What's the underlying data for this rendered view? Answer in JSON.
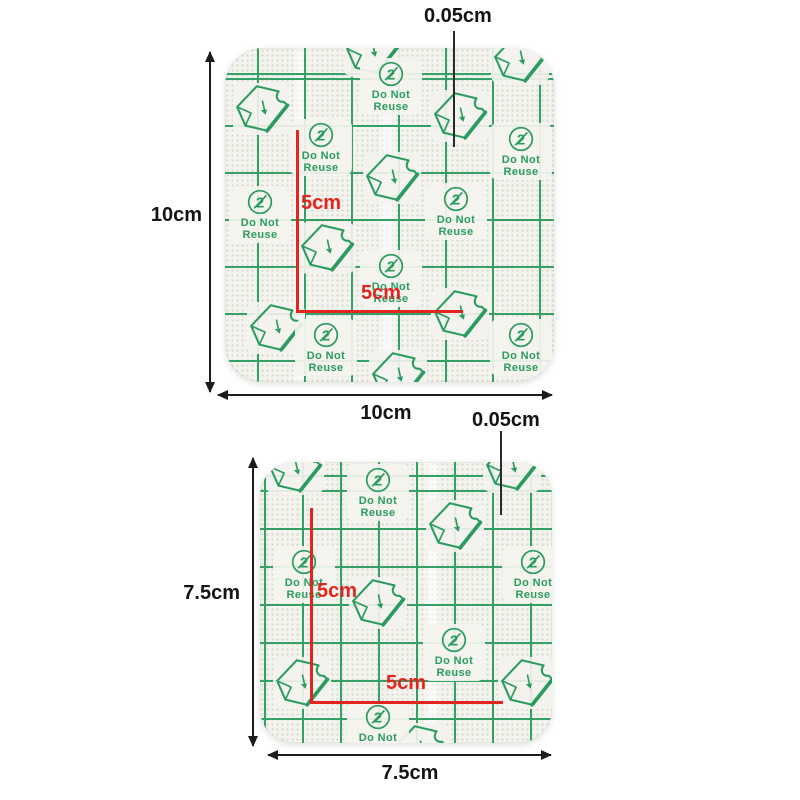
{
  "shared": {
    "do_not_line1": "Do Not",
    "do_not_line2": "Reuse",
    "prohibition_glyph": "2",
    "icons": {
      "do_not_reuse_icon": "circled-2-with-slash",
      "peel_flag_icon": "peel-corner-film-flag"
    },
    "colors": {
      "grid_green": "#2a9c5e",
      "measure_red": "#e4251f",
      "dimension_black": "#1c1c1c",
      "film_fill": "#f4f3ee",
      "background": "#ffffff"
    }
  },
  "top_patch": {
    "height_label": "10cm",
    "width_label": "10cm",
    "thickness_label": "0.05cm",
    "inner_vertical_label": "5cm",
    "inner_horizontal_label": "5cm"
  },
  "bottom_patch": {
    "height_label": "7.5cm",
    "width_label": "7.5cm",
    "thickness_label": "0.05cm",
    "inner_vertical_label": "5cm",
    "inner_horizontal_label": "5cm"
  }
}
